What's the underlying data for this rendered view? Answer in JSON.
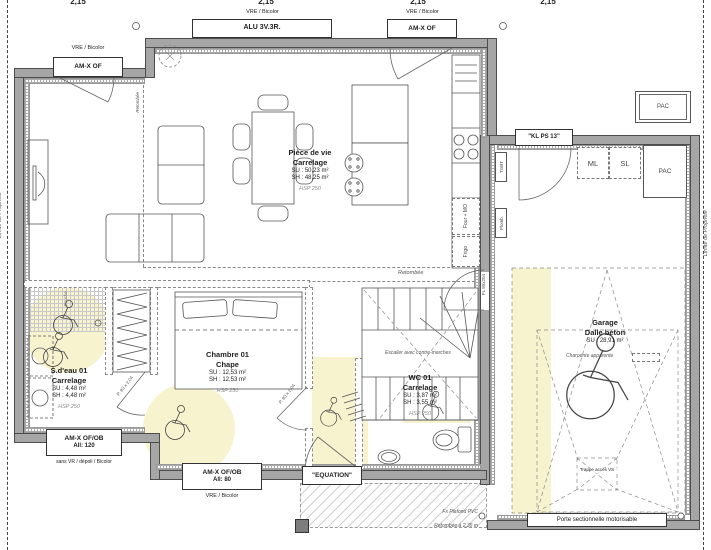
{
  "dimensions": {
    "top": [
      "2,15",
      "2,15",
      "2,15",
      "2,15"
    ]
  },
  "boundary": {
    "left": "Limite de Propriété",
    "right": "Limite de Propriété"
  },
  "windows": {
    "top_left": {
      "note": "VRE / Bicolor",
      "label": "AM-X OF"
    },
    "top_middle": {
      "note": "VRE / Bicolor",
      "label": "ALU 3V.3R."
    },
    "top_right": {
      "note": "VRE / Bicolor",
      "label": "AM-X OF"
    },
    "bottom_left": {
      "label": "AM-X OF/OB",
      "height": "All:  120",
      "note": "sans VR / dépoli / Bicolor"
    },
    "bottom_middle": {
      "label": "AM-X OF/OB",
      "height": "All:  80",
      "note": "VRE / Bicolor"
    }
  },
  "doors": {
    "entry": "\"EQUATION\"",
    "garage_service": "\"KL PS 13\"",
    "sectional": "Porte sectionnelle motorisable",
    "bedroom": "P. 83 x 2,04",
    "bathroom": "P. 83 x 2,04",
    "garage_link": "PL 80x204"
  },
  "rooms": {
    "living": {
      "name": "Pièce de vie",
      "floor": "Carrelage",
      "su": "SU : 50,23 m²",
      "sh": "SH : 48,25 m²",
      "hsp": "HSP 250"
    },
    "bedroom": {
      "name": "Chambre 01",
      "floor": "Chape",
      "su": "SU : 12,53 m²",
      "sh": "SH : 12,53 m²",
      "hsp": "HSP 250"
    },
    "bathroom": {
      "name": "S.d'eau 01",
      "floor": "Carrelage",
      "su": "SU : 4,48 m²",
      "sh": "SH : 4,48 m²",
      "hsp": "HSP 250"
    },
    "wc": {
      "name": "WC 01",
      "floor": "Carrelage",
      "su": "SU : 3,87 m²",
      "sh": "SH : 3,55 m²",
      "hsp": "HSP 250"
    },
    "garage": {
      "name": "Garage",
      "floor": "Dalle béton",
      "su": "SU : 28,91 m²",
      "note": "Charpente apparente"
    }
  },
  "equipment": {
    "ml": "ML",
    "sl": "SL",
    "pac_inside": "PAC",
    "pac_outside": "PAC",
    "oven": "Four + MO",
    "fridge": "Frigo",
    "tgbt": "TGBT",
    "plumbing": "Plomb.",
    "shower": "Douche"
  },
  "annotations": {
    "retombee": "Retombée",
    "retombee_vert": "Retombée",
    "stairs": "Escalier avec contre-marches",
    "ceiling": "Fx Plafond PVC",
    "dropped_ceiling": "Retombée à 2,35 m",
    "hatch_access": "Trappe accès VS"
  },
  "colors": {
    "wall": "#a6a6a6",
    "zone": "#f7f3cf"
  }
}
